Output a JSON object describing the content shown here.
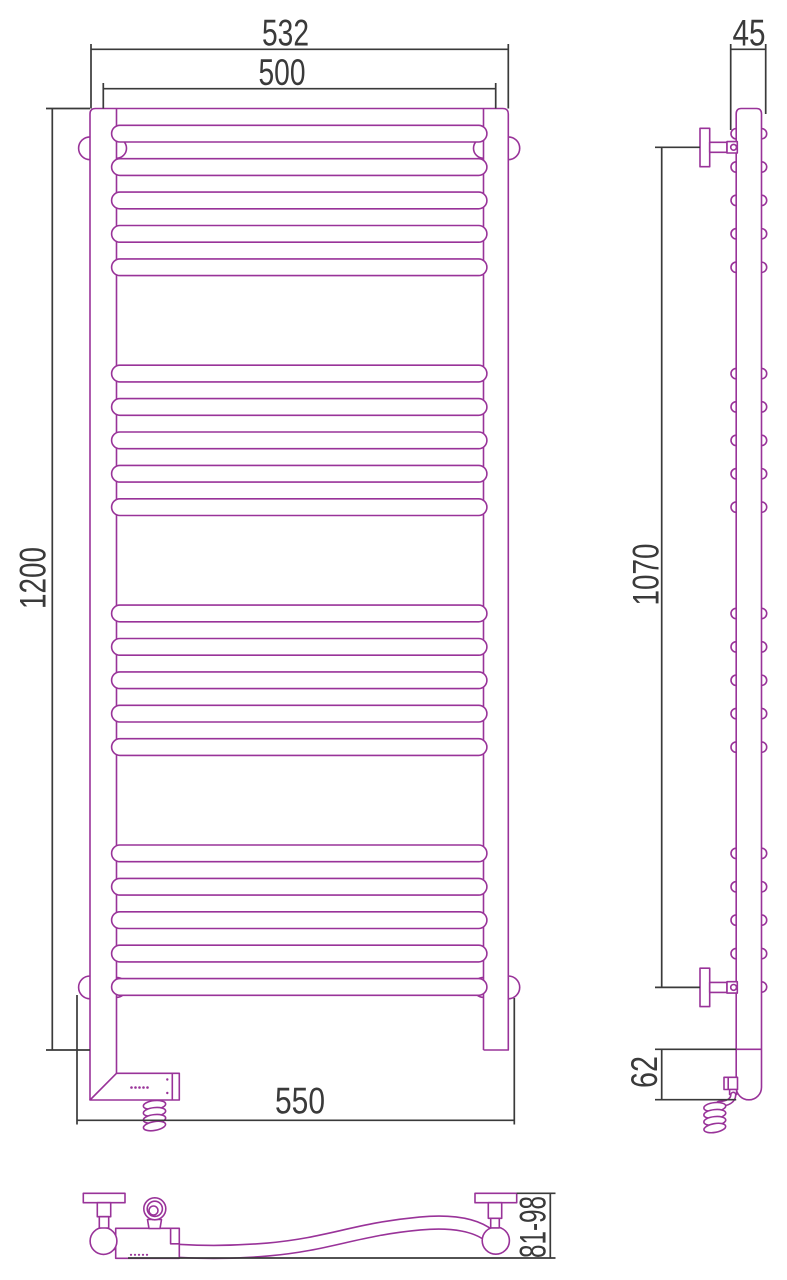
{
  "dims": {
    "front_width_overall": "532",
    "front_width_mount": "500",
    "front_height": "1200",
    "front_width_total": "550",
    "side_depth": "45",
    "side_mount_spacing": "1070",
    "side_bottom_section": "62",
    "wall_offset_range": "81-98"
  },
  "colors": {
    "product_outline": "#993399",
    "dimension_lines": "#3a3a3a",
    "background": "#ffffff"
  },
  "geometry": {
    "rung_groups": 4,
    "rungs_per_group": 5,
    "first_rung_top": 125.3,
    "group_spacing": 239.9,
    "rung_spacing": 33.4
  }
}
